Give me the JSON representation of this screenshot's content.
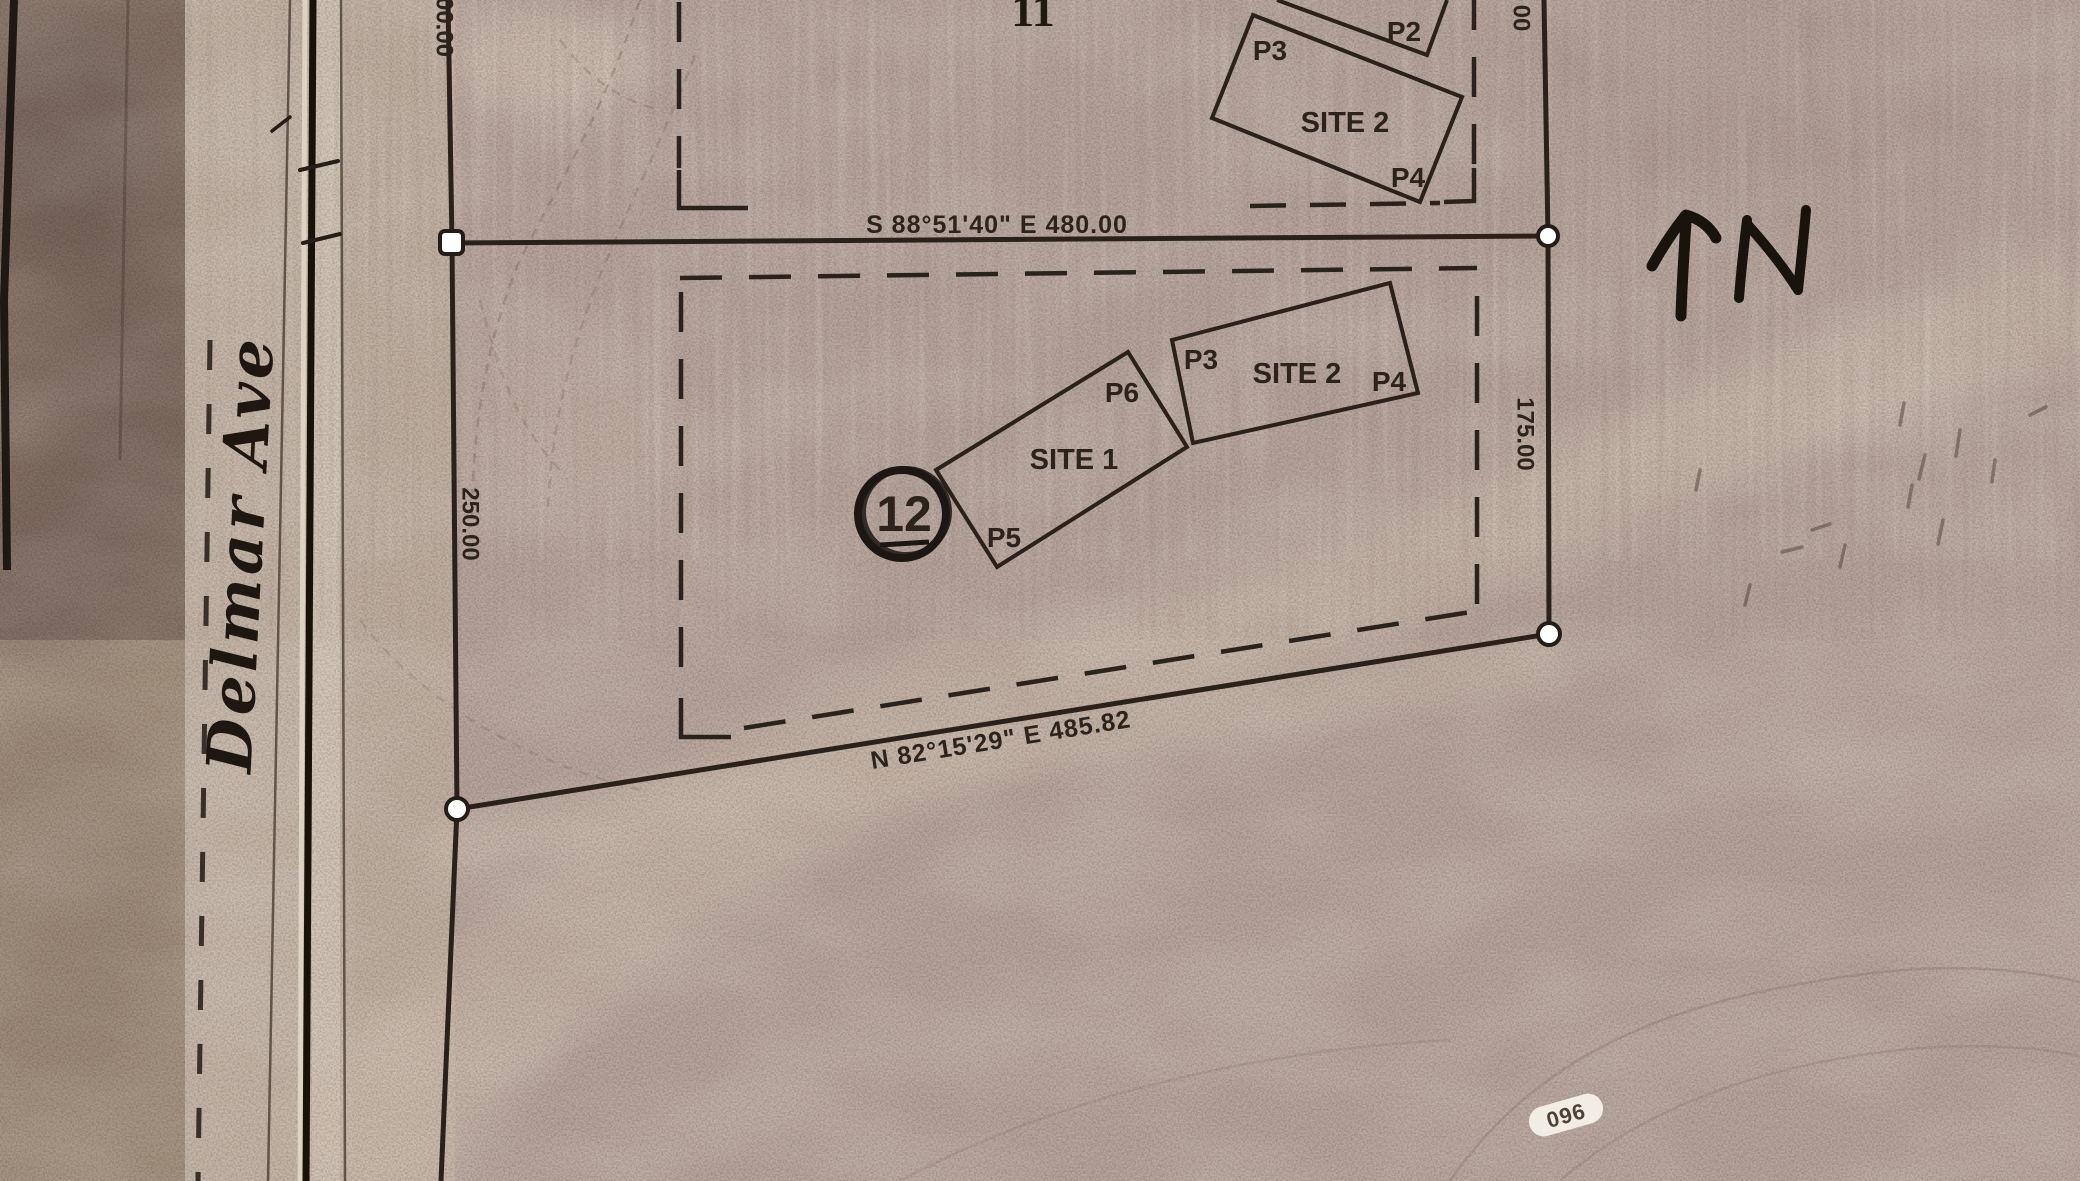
{
  "map": {
    "road_label": "Delmar Ave",
    "upper_section_label": "11",
    "parcel_label": "12",
    "north_label": "N",
    "bearing_top": "S 88°51'40\" E  480.00",
    "bearing_bottom": "N 82°15'29\" E  485.82",
    "dim_left_partial": "00.00",
    "dim_left": "250.00",
    "dim_right": "175.00",
    "dim_right_partial": "00",
    "stamp_label": "096",
    "site1": {
      "label": "SITE 1",
      "p5": "P5",
      "p6": "P6"
    },
    "site2_lower": {
      "label": "SITE 2",
      "p3": "P3",
      "p4": "P4"
    },
    "site2_upper": {
      "label": "SITE 2",
      "p2": "P2",
      "p3": "P3",
      "p4": "P4"
    },
    "colors": {
      "ink": "#29211a",
      "photo_base": "#b7a49b",
      "road_light": "#c6b6a8",
      "field_dark": "#857165",
      "marker_fill": "#ffffff",
      "stamp_fill": "#f5f1e8"
    }
  }
}
